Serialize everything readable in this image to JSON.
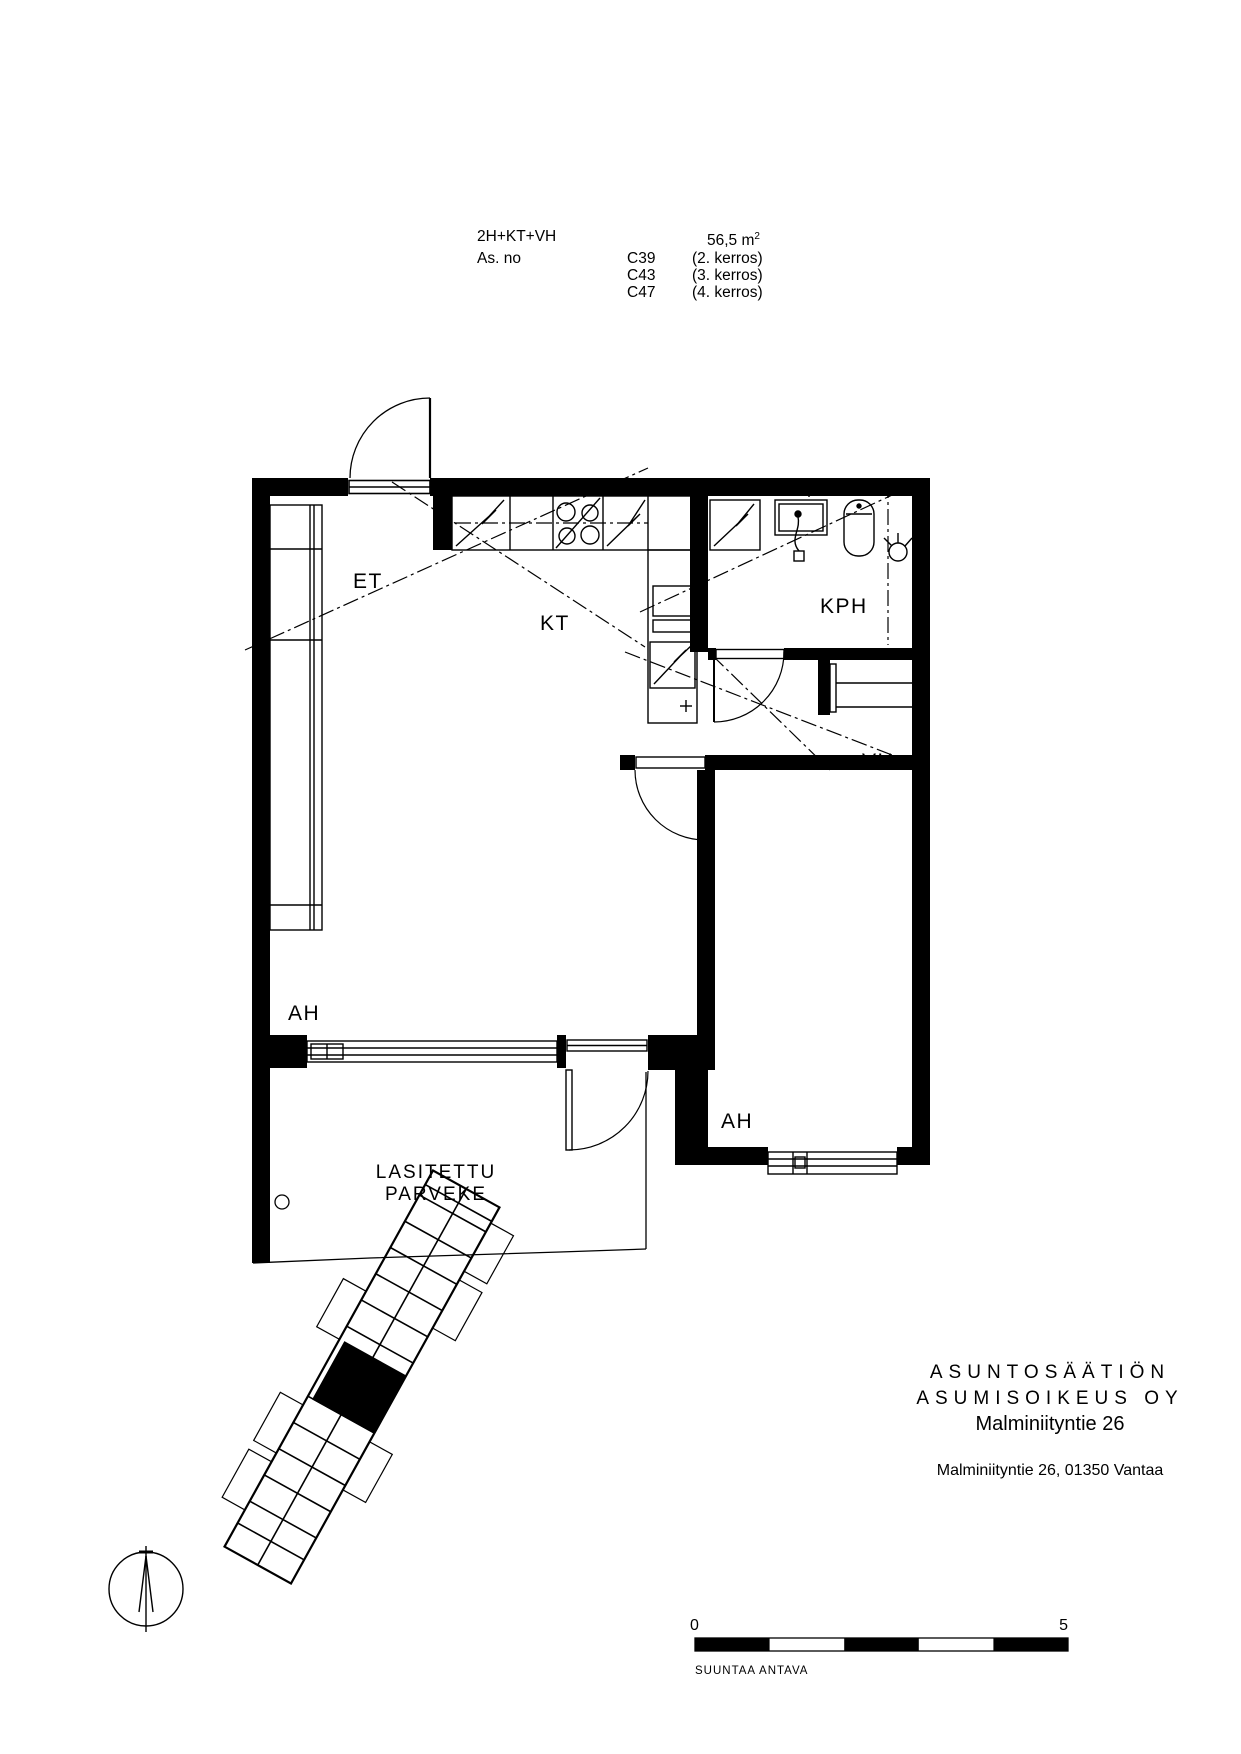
{
  "header": {
    "unit_type": "2H+KT+VH",
    "as_no_label": "As. no",
    "area_value": "56,5 m",
    "area_sup": "2",
    "apartments": [
      {
        "code": "C39",
        "floor": "(2. kerros)"
      },
      {
        "code": "C43",
        "floor": "(3. kerros)"
      },
      {
        "code": "C47",
        "floor": "(4. kerros)"
      }
    ]
  },
  "plan": {
    "rooms": {
      "entry": "ET",
      "kitchen": "KT",
      "bathroom": "KPH",
      "closet": "VH",
      "living": "AH",
      "bedroom": "AH",
      "balcony_line1": "LASITETTU",
      "balcony_line2": "PARVEKE"
    }
  },
  "footer": {
    "company_line1": "ASUNTOSÄÄTIÖN",
    "company_line2": "ASUMISOIKEUS OY",
    "company_line3": "Malminiityntie 26",
    "address": "Malminiityntie 26, 01350 Vantaa",
    "scale": {
      "start": "0",
      "end": "5",
      "note": "SUUNTAA ANTAVA"
    }
  },
  "colors": {
    "ink": "#000000",
    "paper": "#ffffff"
  }
}
